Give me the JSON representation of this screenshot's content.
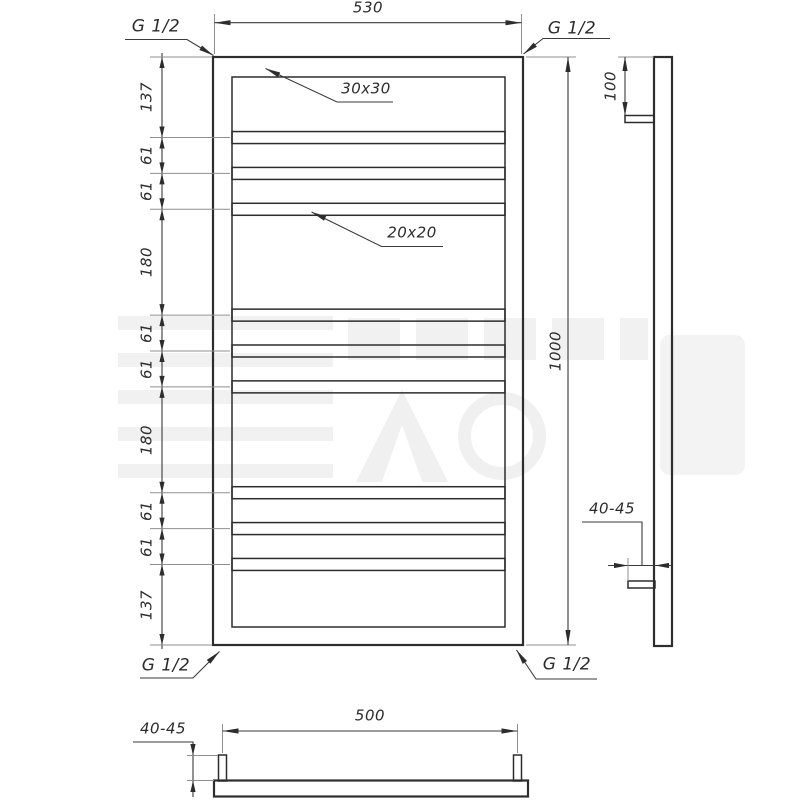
{
  "colors": {
    "line": "#2d2d2d",
    "dim_line": "#3a3a3a",
    "extension_line": "#8f8f8f",
    "background": "#ffffff",
    "watermark": "#f1f1f1"
  },
  "front_view": {
    "overall_width": "530",
    "overall_height": "1000",
    "frame_profile_label": "30x30",
    "rung_profile_label": "20x20",
    "thread_label": "G 1/2",
    "left_dim_chain": [
      "137",
      "61",
      "61",
      "180",
      "61",
      "61",
      "180",
      "61",
      "61",
      "137"
    ]
  },
  "side_view": {
    "top_offset": "100",
    "wall_distance": "40-45"
  },
  "bottom_view": {
    "connection_spacing": "500",
    "wall_distance": "40-45"
  }
}
